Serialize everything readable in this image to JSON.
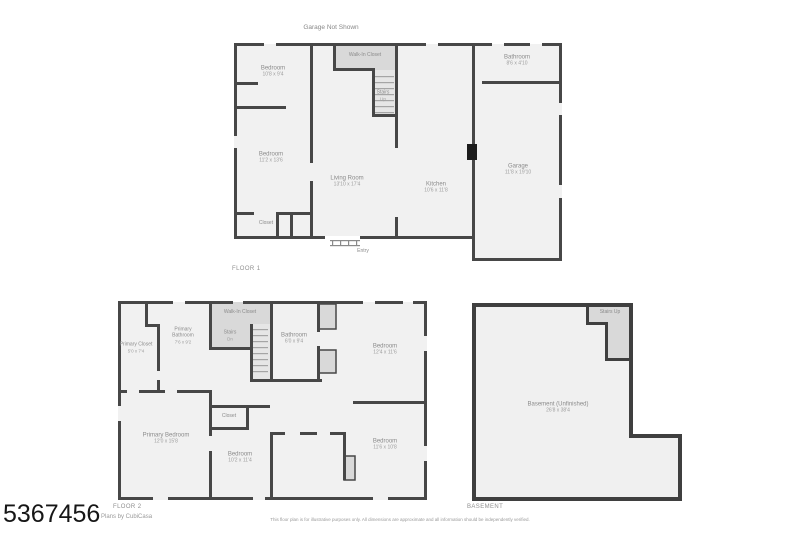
{
  "page": {
    "mls_number": "5367456",
    "credit": "Plans by CubiCasa",
    "note_above_plan": "Garage Not Shown",
    "disclaimer": "This floor plan is for illustrative purposes only. All dimensions are approximate and all information should be independently verified."
  },
  "colors": {
    "wall": "#474747",
    "room_fill": "#f1f1f1",
    "shaded_fill": "#d9d9d9",
    "label_text": "#8f8f8f"
  },
  "floor1": {
    "title": "FLOOR 1",
    "rooms": {
      "bedroom_a": {
        "name": "Bedroom",
        "dims": "10'8 x 9'4"
      },
      "bedroom_b": {
        "name": "Bedroom",
        "dims": "11'2 x 13'6"
      },
      "closet": {
        "name": "Closet"
      },
      "walk_in_closet": {
        "name": "Walk-In Closet"
      },
      "stairs": {
        "name": "Stairs",
        "dims": "Up"
      },
      "living_room": {
        "name": "Living Room",
        "dims": "13'10 x 17'4"
      },
      "kitchen": {
        "name": "Kitchen",
        "dims": "10'6 x 11'8"
      },
      "bathroom": {
        "name": "Bathroom",
        "dims": "8'6 x 4'10"
      },
      "garage": {
        "name": "Garage",
        "dims": "11'8 x 19'10"
      },
      "entry": {
        "name": "Entry"
      }
    }
  },
  "floor2": {
    "title": "FLOOR 2",
    "rooms": {
      "primary_closet": {
        "name": "Primary Closet",
        "dims": "5'0 x 7'4"
      },
      "primary_bathroom": {
        "name": "Primary Bathroom",
        "dims": "7'6 x 9'2"
      },
      "walk_in_closet": {
        "name": "Walk-In Closet"
      },
      "stairs": {
        "name": "Stairs",
        "dims": "Dn"
      },
      "bathroom": {
        "name": "Bathroom",
        "dims": "6'0 x 9'4"
      },
      "bedroom_a": {
        "name": "Bedroom",
        "dims": "12'4 x 11'6"
      },
      "primary_bedroom": {
        "name": "Primary Bedroom",
        "dims": "12'0 x 15'8"
      },
      "closet": {
        "name": "Closet"
      },
      "bedroom_b": {
        "name": "Bedroom",
        "dims": "10'2 x 11'4"
      },
      "bedroom_c": {
        "name": "Bedroom",
        "dims": "11'6 x 10'8"
      }
    }
  },
  "basement": {
    "title": "BASEMENT",
    "rooms": {
      "basement": {
        "name": "Basement (Unfinished)",
        "dims": "26'8 x 38'4"
      },
      "stairs": {
        "name": "Stairs Up"
      }
    }
  }
}
